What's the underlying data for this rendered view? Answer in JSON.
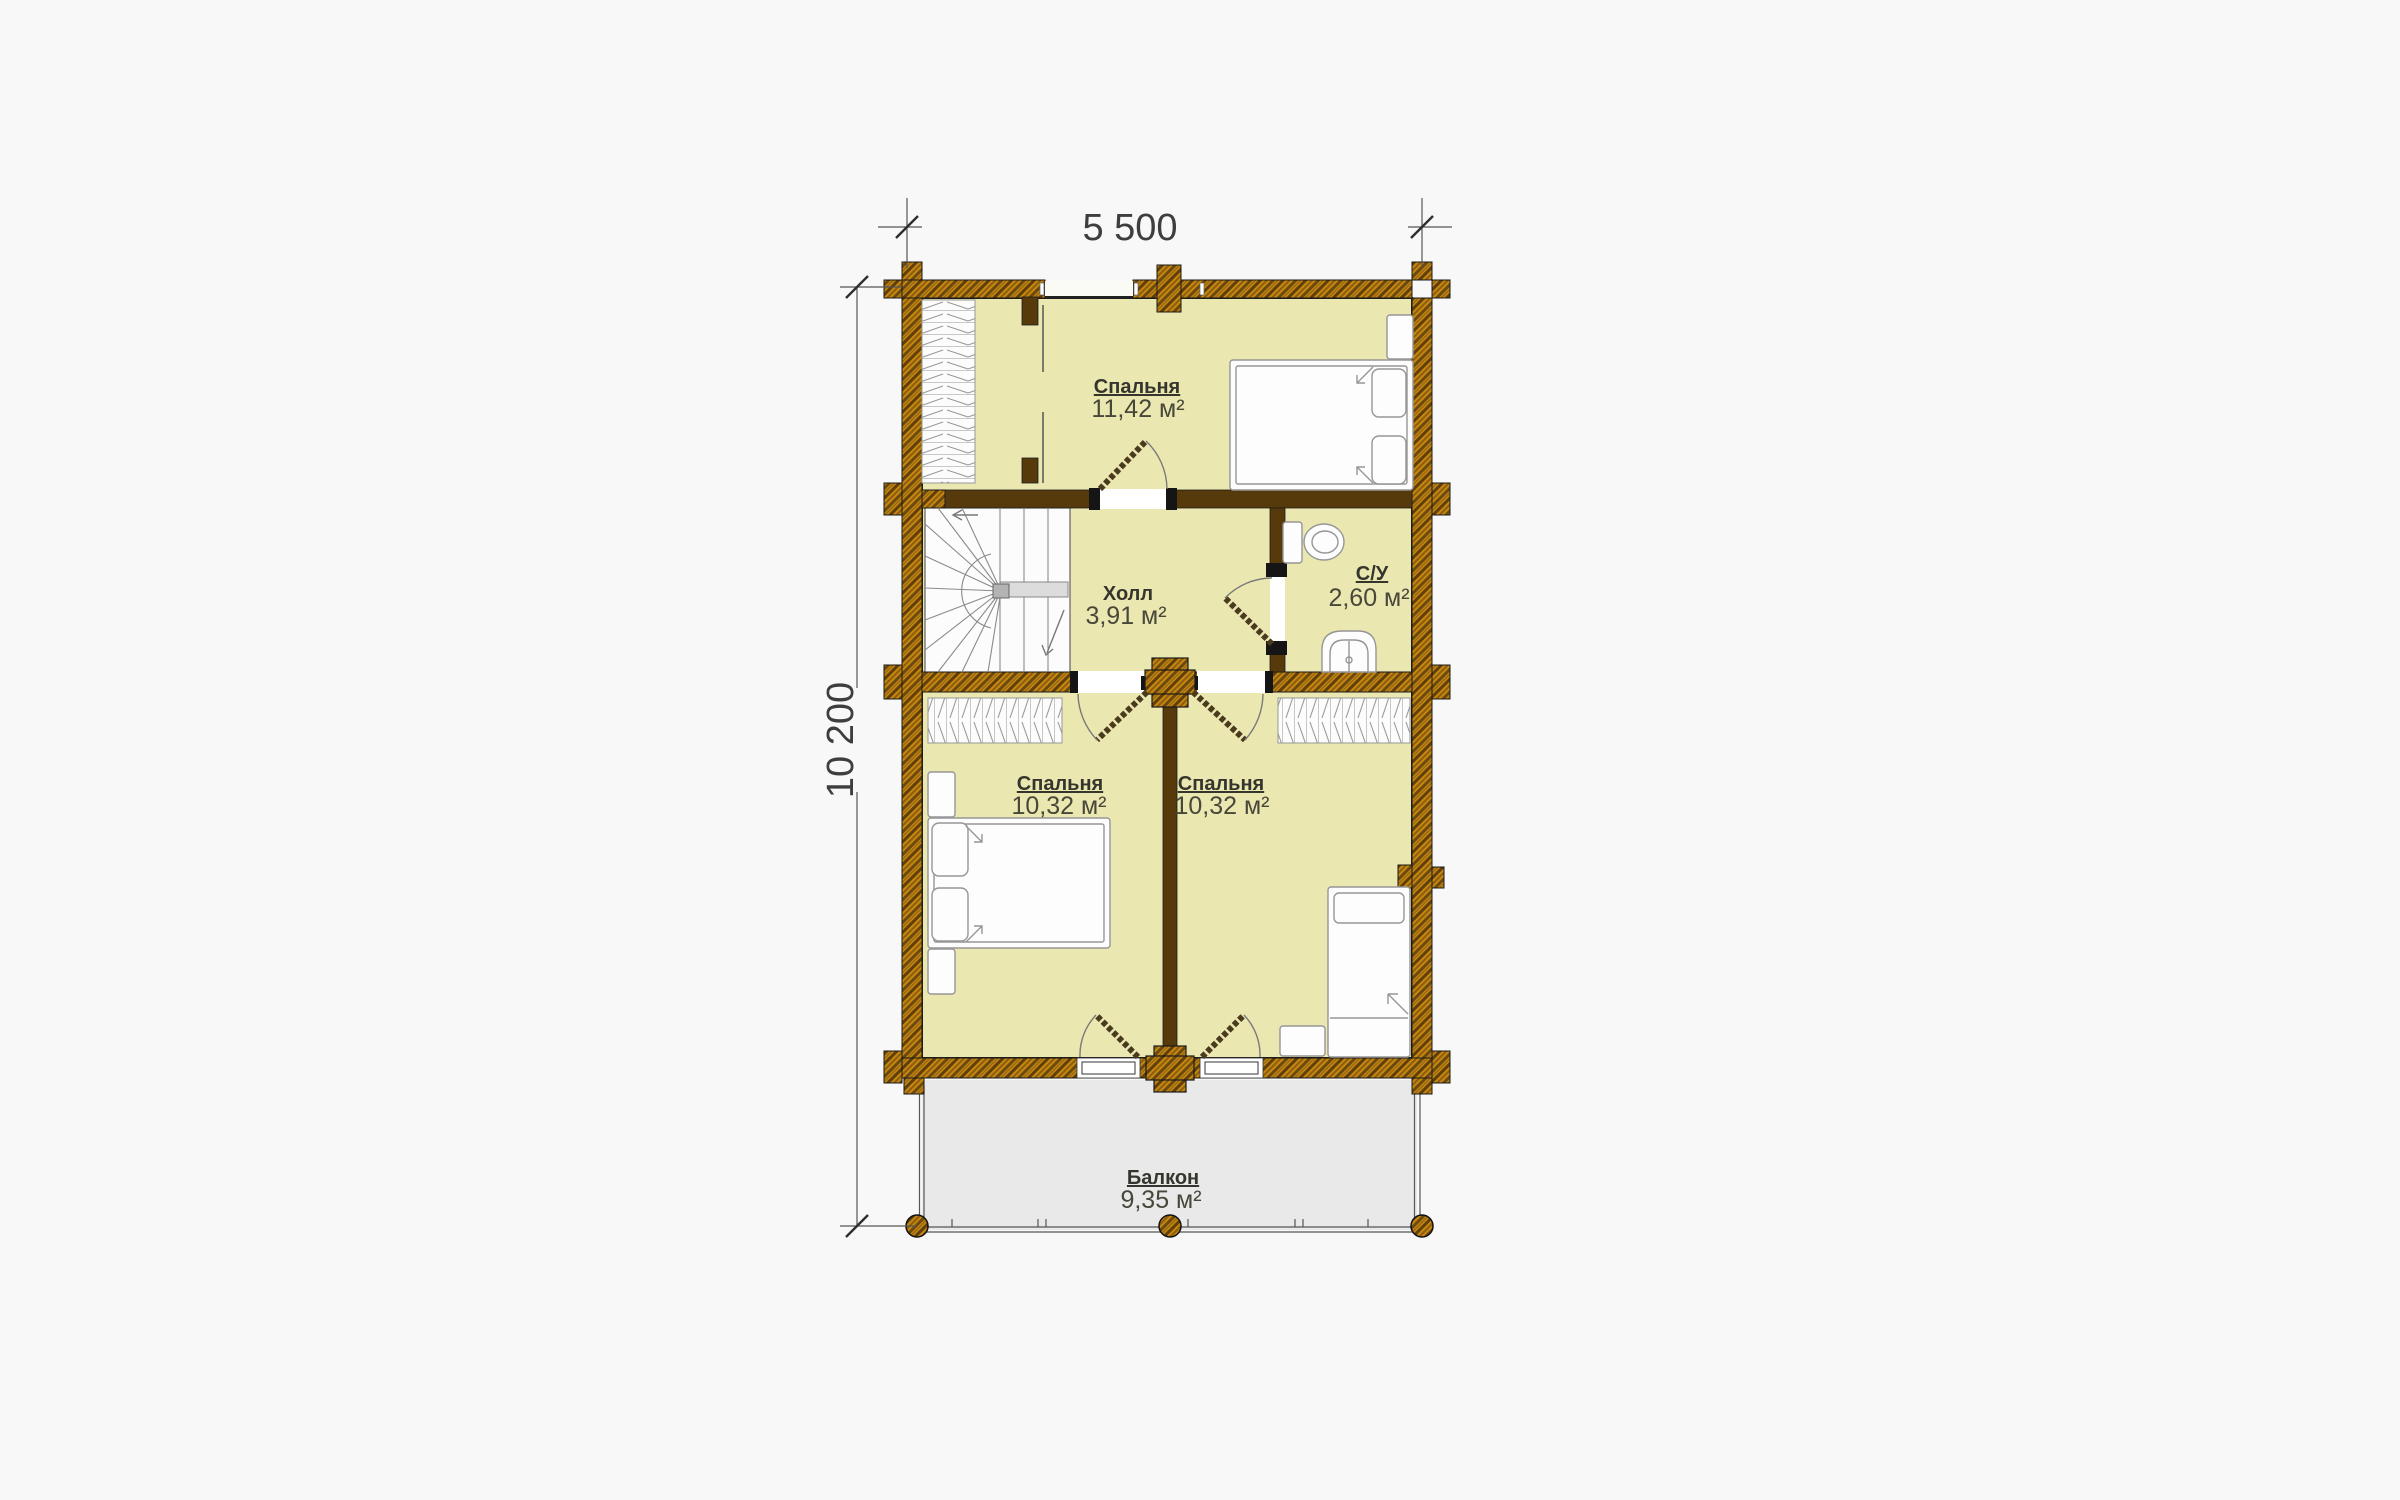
{
  "title": "План этажа — поэтажный план дома",
  "dimensions": {
    "width_label": "5 500",
    "height_label": "10 200"
  },
  "rooms": {
    "bedroom_top": {
      "name": "Спальня",
      "area": "11,42 м²"
    },
    "hall": {
      "name": "Холл",
      "area": "3,91 м²"
    },
    "bathroom": {
      "name": "С/У",
      "area": "2,60 м²"
    },
    "bedroom_left": {
      "name": "Спальня",
      "area": "10,32 м²"
    },
    "bedroom_right": {
      "name": "Спальня",
      "area": "10,32 м²"
    },
    "balcony": {
      "name": "Балкон",
      "area": "9,35 м²"
    }
  },
  "fixtures": [
    "log-wall",
    "double-bed",
    "single-bed",
    "wardrobe",
    "closet",
    "spiral-stairs",
    "toilet",
    "sink",
    "balcony-posts",
    "door-swing"
  ],
  "colors": {
    "background": "#f8f8f8",
    "floor": "#ebe7b0",
    "log_wall_gold": "#c8860e",
    "log_wall_dark": "#5f3f0a",
    "interior_wall": "#573a0c",
    "balcony_floor": "#e9e9e9",
    "label_text": "#35352e",
    "value_text": "#47473a",
    "dimension_text": "#3e3e3e"
  }
}
